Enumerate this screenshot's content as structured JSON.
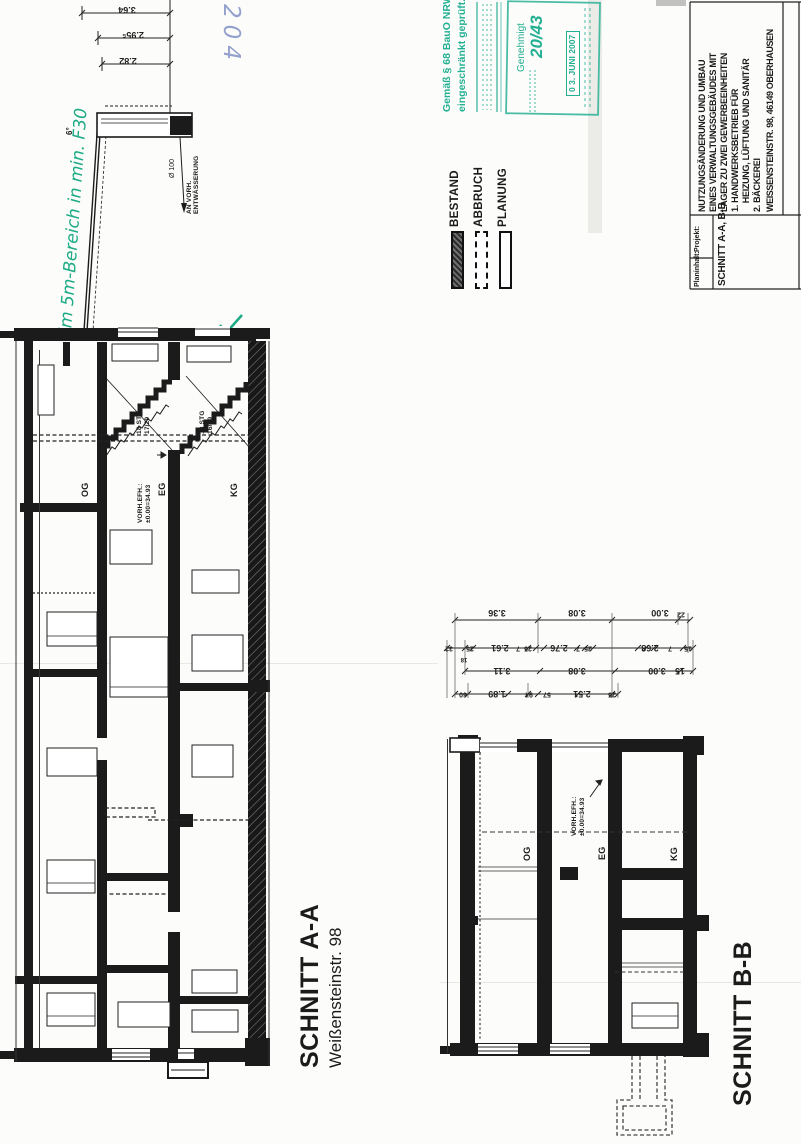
{
  "title_block": {
    "projekt_label": "Projekt:",
    "projekt_lines": [
      "NUTZUNGSÄNDERUNG UND UMBAU",
      "EINES VERWALTUNGSGEBÄUDES MIT",
      "LAGER ZU ZWEI GEWERBEEINHEITEN",
      "1. HANDWERKSBETRIEB FÜR",
      "    HEIZUNG, LÜFTUNG UND SANITÄR",
      "2. BÄCKEREI",
      "WEISSENSTEINSTR. 98, 46149 OBERHAUSEN"
    ],
    "planinhalt_label": "Planinhalt:",
    "planinhalt_value": "SCHNITT A-A, B-B"
  },
  "stamps": {
    "pruef_line1": "Gemäß § 68 BauO NRW",
    "pruef_line2": "eingeschränkt geprüft.",
    "genehmigt_label": "Genehmigt",
    "genehmigt_number": "20/43",
    "genehmigt_date": "0 3. JUNI 2007",
    "stamp_color": "#23af92"
  },
  "annotations": {
    "green_note": "im 5m-Bereich in min. F30",
    "blue_number": "204",
    "green_color": "#1cab84",
    "blue_color": "#8292c5"
  },
  "legend": {
    "items": [
      {
        "label": "BESTAND",
        "style": "hatched"
      },
      {
        "label": "ABBRUCH",
        "style": "dashed"
      },
      {
        "label": "PLANUNG",
        "style": "outline"
      }
    ]
  },
  "section_aa": {
    "title": "SCHNITT A-A",
    "subtitle": "Weißensteinstr. 98",
    "floor_labels": [
      "OG",
      "EG",
      "KG"
    ],
    "stair1_line1": "18 STG",
    "stair1_line2": "17/29",
    "stair2_line1": "18 STG",
    "stair2_line2": "16/29",
    "level_line1": "VORH.EFH.:",
    "level_line2": "±0.00=34.93",
    "roof_pitch": "6°",
    "drain_dia": "Ø 100",
    "drain_line1": "AN VORH.",
    "drain_line2": "ENTWÄSSERUNG",
    "height_dims": [
      "3.64",
      "2.95⁵",
      "2.82"
    ]
  },
  "section_bb": {
    "title": "SCHNITT B-B",
    "floor_labels": [
      "OG",
      "EG",
      "KG"
    ],
    "level_line1": "VORH.EFH.:",
    "level_line2": "±0.00=34.93",
    "dim_row1": [
      "3.36",
      "3.08",
      "3.00",
      "22"
    ],
    "dim_row2": [
      "32",
      "25",
      "2.61",
      "7",
      "25",
      "2.76",
      "7",
      "25",
      "2.68",
      "7",
      "15",
      "18"
    ],
    "dim_row3": [
      "3.11",
      "3.08",
      "3.00",
      "15"
    ],
    "dim_row4": [
      "60",
      "1.89",
      "94",
      "57",
      "2.51",
      "25"
    ]
  }
}
